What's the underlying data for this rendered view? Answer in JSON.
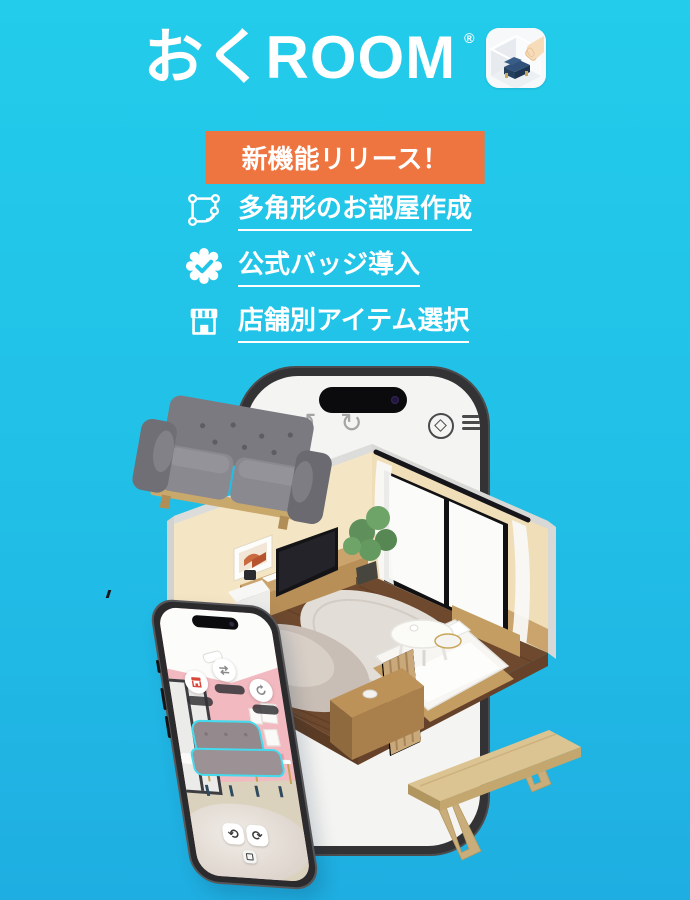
{
  "theme": {
    "bg_top": "#23CCEA",
    "bg_bottom": "#1FAEE1",
    "accent_orange": "#EE7440",
    "text_white": "#FFFFFF",
    "selection_cyan": "#45DBEE"
  },
  "header": {
    "app_name": "おくROOM",
    "registered_mark": "®",
    "app_icon": "app-icon-sofa-placement"
  },
  "banner": {
    "label": "新機能リリース！"
  },
  "features": [
    {
      "icon": "polygon-room-icon",
      "label": "多角形のお部屋作成"
    },
    {
      "icon": "verified-badge-icon",
      "label": "公式バッジ導入"
    },
    {
      "icon": "storefront-icon",
      "label": "店舗別アイテム選択"
    }
  ],
  "mockup_large": {
    "toolbar_icons": [
      "undo-icon",
      "redo-icon",
      "rotate-view-icon",
      "menu-icon"
    ],
    "scene": "isometric room with bed, TV, plant, coffee table and rug"
  },
  "mockup_small": {
    "scene": "camera view of pink room with selected sofa",
    "fab_icons": [
      "shop-icon",
      "swap-icon",
      "refresh-icon"
    ],
    "control_icons": [
      "rotate-left-icon",
      "rotate-right-icon",
      "move-icon"
    ]
  },
  "floating_items": [
    "gray-sofa",
    "wood-bench"
  ],
  "glyphs": {
    "undo": "↺",
    "redo": "↻",
    "rotate_left": "⟲",
    "rotate_right": "⟳"
  }
}
